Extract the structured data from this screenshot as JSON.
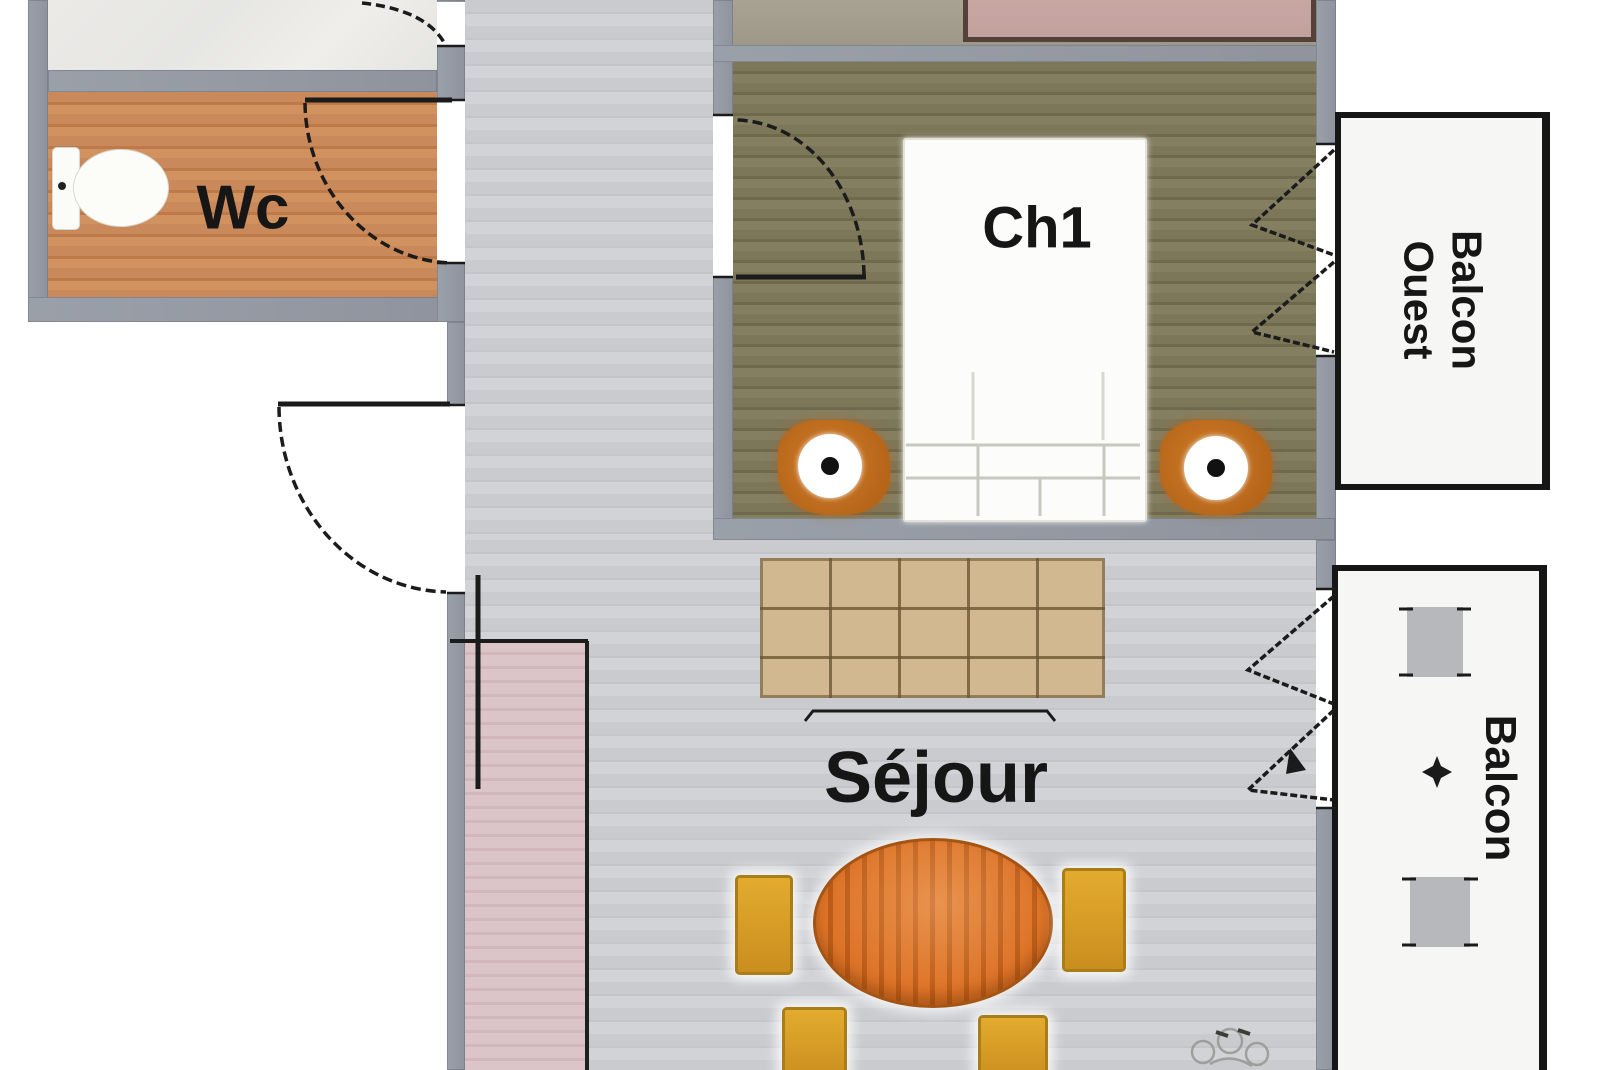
{
  "plan_type": "apartment-floor-plan",
  "rooms": {
    "wc": {
      "label": "Wc"
    },
    "ch1": {
      "label": "Ch1"
    },
    "sejour": {
      "label": "Séjour"
    },
    "balcon_ouest": {
      "line1": "Balcon",
      "line2": "Ouest"
    },
    "balcon": {
      "label": "Balcon"
    }
  },
  "furniture": [
    "toilet",
    "double-bed",
    "bedside-table",
    "table-lamp",
    "pink-bed",
    "sofa",
    "dining-table",
    "dining-chair",
    "balcony-table",
    "balcony-chair",
    "plant",
    "door-swing",
    "casement-window"
  ],
  "colors": {
    "exterior": "#ffffff",
    "wall": "#9aa0a9",
    "floor_corridor": "#cacbcf",
    "floor_wc": "#c9895a",
    "floor_ch1": "#7d775a",
    "floor_entry_pink": "#dcc5c9",
    "balcony_fill": "#f6f6f4",
    "balcony_border": "#161616",
    "balcony_item_gray": "#b7b8bc",
    "bed_white": "#fcfcfa",
    "bed_pink": "#c2a19d",
    "bed_pink_border": "#53413a",
    "sofa": "#d2b891",
    "table_orange": "#dd7428",
    "chair_yellow": "#d89e27",
    "nightstand": "#b56418",
    "line_black": "#1b1b1b",
    "text": "#161616"
  }
}
